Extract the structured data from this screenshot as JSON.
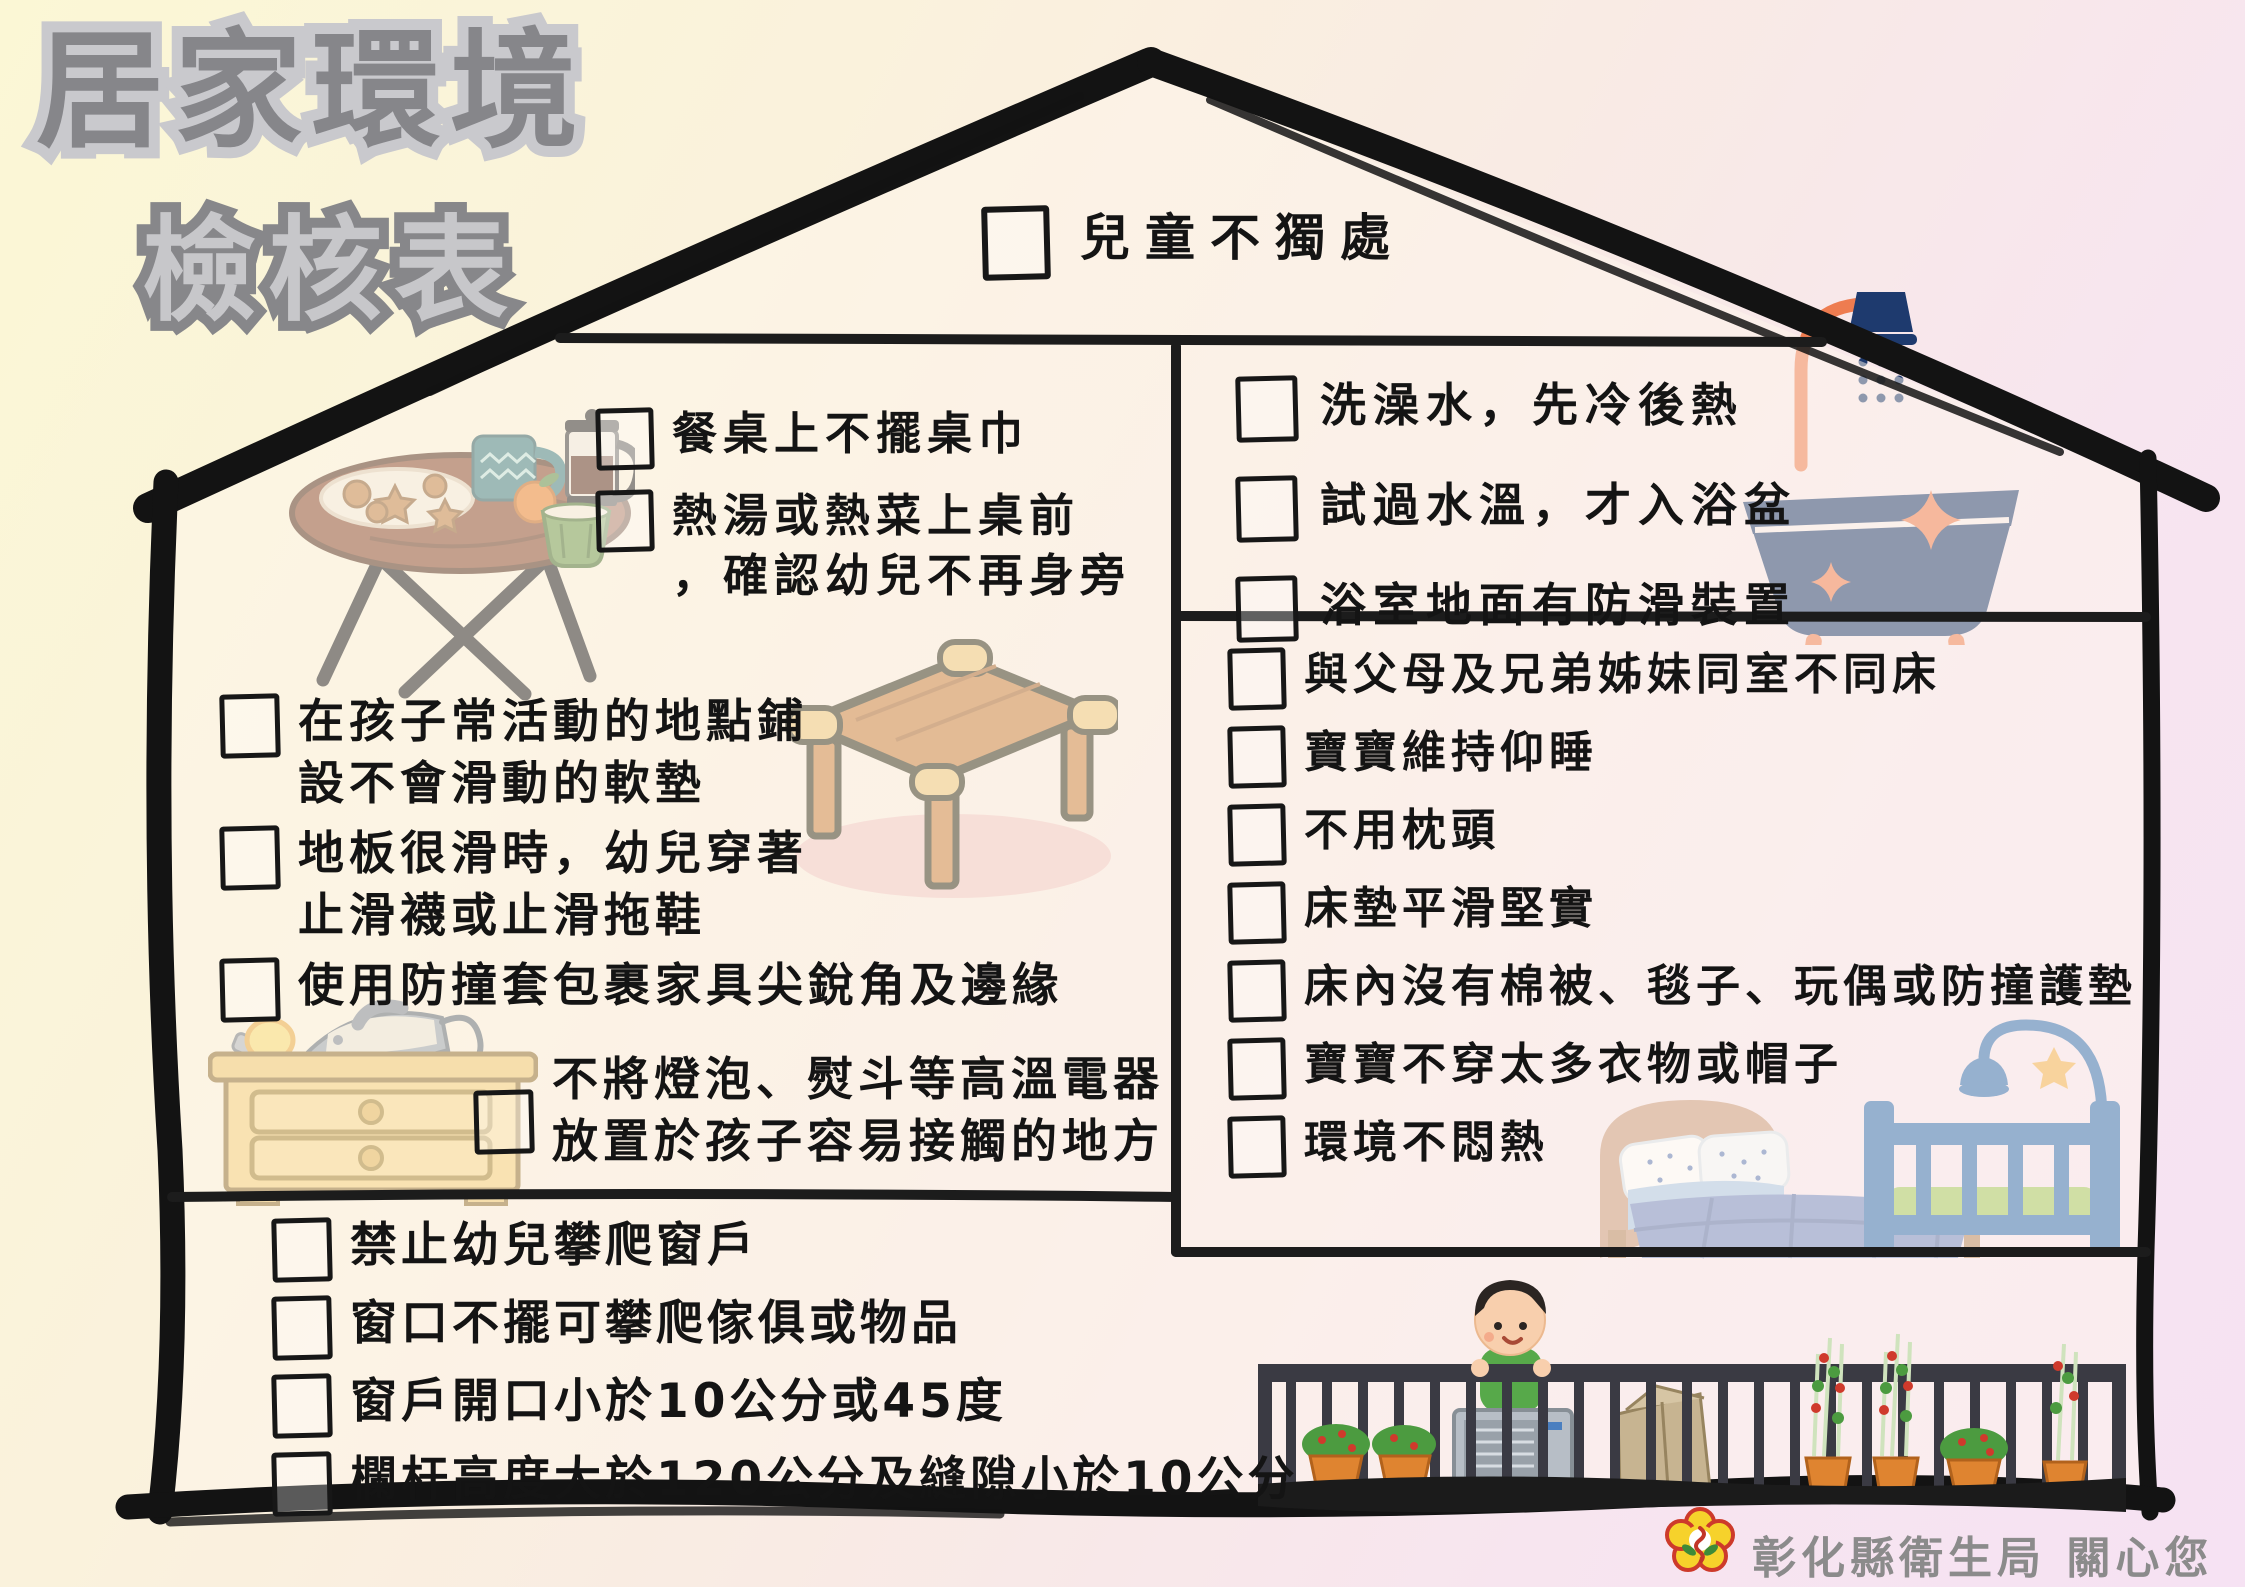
{
  "title": {
    "line1": "居家環境",
    "line2": "檢核表"
  },
  "rooftop_item": {
    "text": "兒童不獨處"
  },
  "dining": {
    "items": [
      {
        "text": "餐桌上不擺桌巾"
      },
      {
        "line1": "熱湯或熱菜上桌前",
        "line2": "，確認幼兒不再身旁"
      }
    ]
  },
  "living": {
    "items": [
      {
        "line1": "在孩子常活動的地點鋪",
        "line2": "設不會滑動的軟墊"
      },
      {
        "line1": "地板很滑時，幼兒穿著",
        "line2": "止滑襪或止滑拖鞋"
      },
      {
        "text": "使用防撞套包裹家具尖銳角及邊緣"
      },
      {
        "line1": "不將燈泡、熨斗等高溫電器",
        "line2": "放置於孩子容易接觸的地方"
      }
    ]
  },
  "bathroom": {
    "items": [
      {
        "text": "洗澡水，先冷後熱"
      },
      {
        "text": "試過水溫，才入浴盆"
      },
      {
        "text": "浴室地面有防滑裝置"
      }
    ]
  },
  "bedroom": {
    "items": [
      {
        "text": "與父母及兄弟姊妹同室不同床"
      },
      {
        "text": "寶寶維持仰睡"
      },
      {
        "text": "不用枕頭"
      },
      {
        "text": "床墊平滑堅實"
      },
      {
        "text": "床內沒有棉被、毯子、玩偶或防撞護墊"
      },
      {
        "text": "寶寶不穿太多衣物或帽子"
      },
      {
        "text": "環境不悶熱"
      }
    ]
  },
  "balcony": {
    "items": [
      {
        "text": "禁止幼兒攀爬窗戶"
      },
      {
        "text": "窗口不擺可攀爬傢俱或物品"
      },
      {
        "text": "窗戶開口小於10公分或45度"
      },
      {
        "text": "欄杆高度大於120公分及縫隙小於10公分"
      }
    ]
  },
  "footer": {
    "org": "彰化縣衛生局 關心您"
  },
  "colors": {
    "ink": "#161616",
    "title_fill": "#86868a",
    "title_outline": "#c9c9cd",
    "navy": "#1e3a6e",
    "orange": "#ee7c50",
    "wood": "#c9813e",
    "dresser_yellow": "#f4cf79",
    "crib_blue": "#2f6cb2",
    "mattress_green": "#a2c95f",
    "railing": "#3a3a43",
    "pot_orange": "#df8430",
    "logo_yellow": "#f6d22b"
  },
  "icons": [
    "checkbox",
    "dining-table",
    "low-table",
    "iron-on-dresser",
    "bathtub-shower",
    "bed",
    "crib-with-mobile",
    "balcony-scene",
    "health-bureau-logo"
  ]
}
